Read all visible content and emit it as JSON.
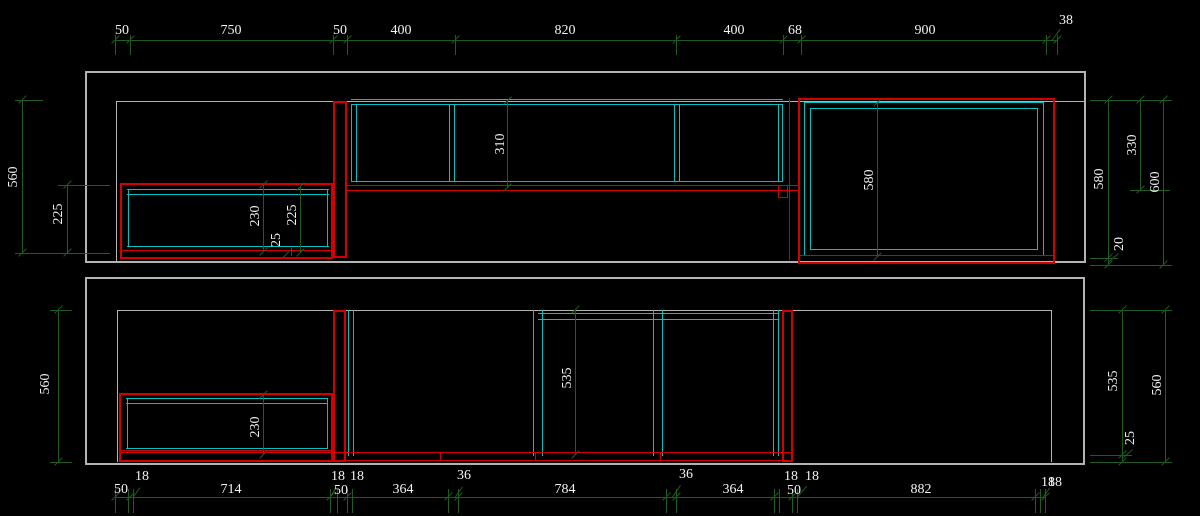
{
  "colors": {
    "background": "#000000",
    "wall_outline": "#b3b3b3",
    "cabinet_red": "#d40000",
    "cabinet_cyan": "#00c2c2",
    "dimension_line": "#1f5c1f",
    "dimension_text": "#f2f2f2"
  },
  "top_chain": {
    "d1": "50",
    "d2": "750",
    "d3": "50",
    "d4": "400",
    "d5": "820",
    "d6": "400",
    "d7": "68",
    "d8": "900",
    "d9": "38"
  },
  "upper_left": {
    "d560": "560",
    "d225": "225"
  },
  "upper_cabinet": {
    "d230": "230",
    "d25": "25",
    "d225": "225"
  },
  "upper_wall": {
    "d310": "310"
  },
  "upper_tall": {
    "d580": "580"
  },
  "upper_right": {
    "d580": "580",
    "d330": "330",
    "d600": "600",
    "d20": "20"
  },
  "lower_left": {
    "d560": "560"
  },
  "lower_cabinet": {
    "d230": "230"
  },
  "lower_mid": {
    "d535": "535"
  },
  "lower_right": {
    "d535": "535",
    "d25": "25",
    "d560": "560"
  },
  "bottom_chain": {
    "d1": "50",
    "d2": "18",
    "d3": "714",
    "d4": "18",
    "d5": "50",
    "d6": "18",
    "d7": "364",
    "d8": "36",
    "d9": "784",
    "d10": "36",
    "d11": "364",
    "d12": "18",
    "d13": "50",
    "d14": "18",
    "d15": "882",
    "d16": "18",
    "d17": "18"
  }
}
